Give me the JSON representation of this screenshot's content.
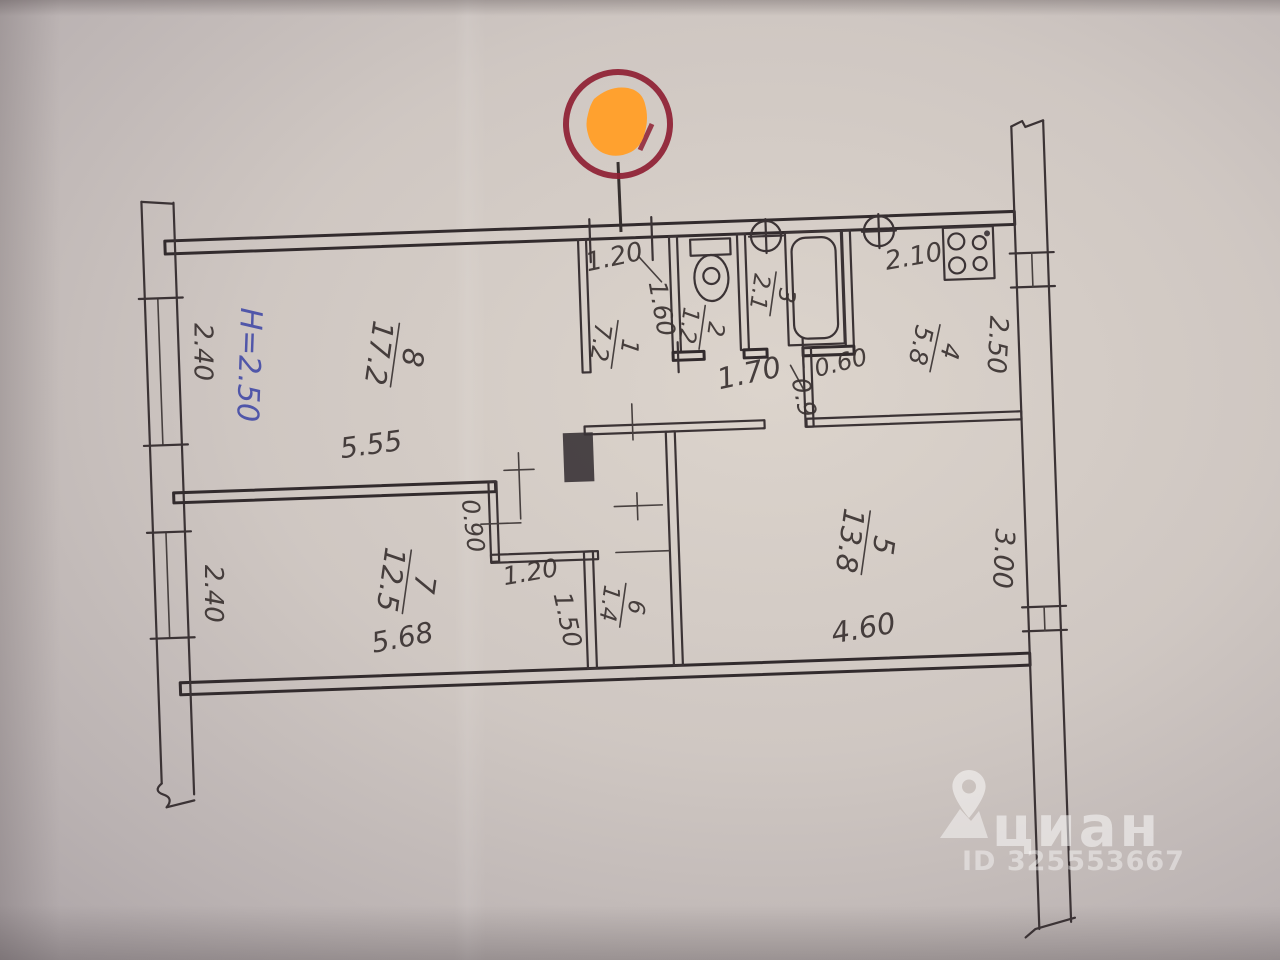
{
  "plan": {
    "height_note": "H=2.50",
    "rooms": [
      {
        "number": "1",
        "area": "7.2"
      },
      {
        "number": "2",
        "area": "1.2"
      },
      {
        "number": "3",
        "area": "2.1"
      },
      {
        "number": "4",
        "area": "5.8"
      },
      {
        "number": "5",
        "area": "13.8"
      },
      {
        "number": "6",
        "area": "1.4"
      },
      {
        "number": "7",
        "area": "12.5"
      },
      {
        "number": "8",
        "area": "17.2"
      }
    ],
    "dimensions": {
      "hall_entry_width": "1.20",
      "hall_depth": "1.60",
      "kitchen_top": "2.10",
      "kitchen_width": "2.50",
      "bath_block_width": "1.70",
      "kitchen_door": "0.9",
      "duct_width": "0.60",
      "room8_length": "5.55",
      "room8_left": "2.40",
      "niche_depth": "0.90",
      "niche_width": "1.20",
      "corridor_length": "1.50",
      "room7_length": "5.68",
      "room7_left": "2.40",
      "room5_length": "4.60",
      "room5_width": "3.00"
    },
    "colors": {
      "ink": "#3b3335",
      "blue_ink": "#4a51a8",
      "marker_ring": "#8e2033",
      "marker_fill": "#ffa12f",
      "paper": "#cfc7c2"
    }
  },
  "watermark": {
    "brand": "циан",
    "id": "ID 325553667"
  }
}
